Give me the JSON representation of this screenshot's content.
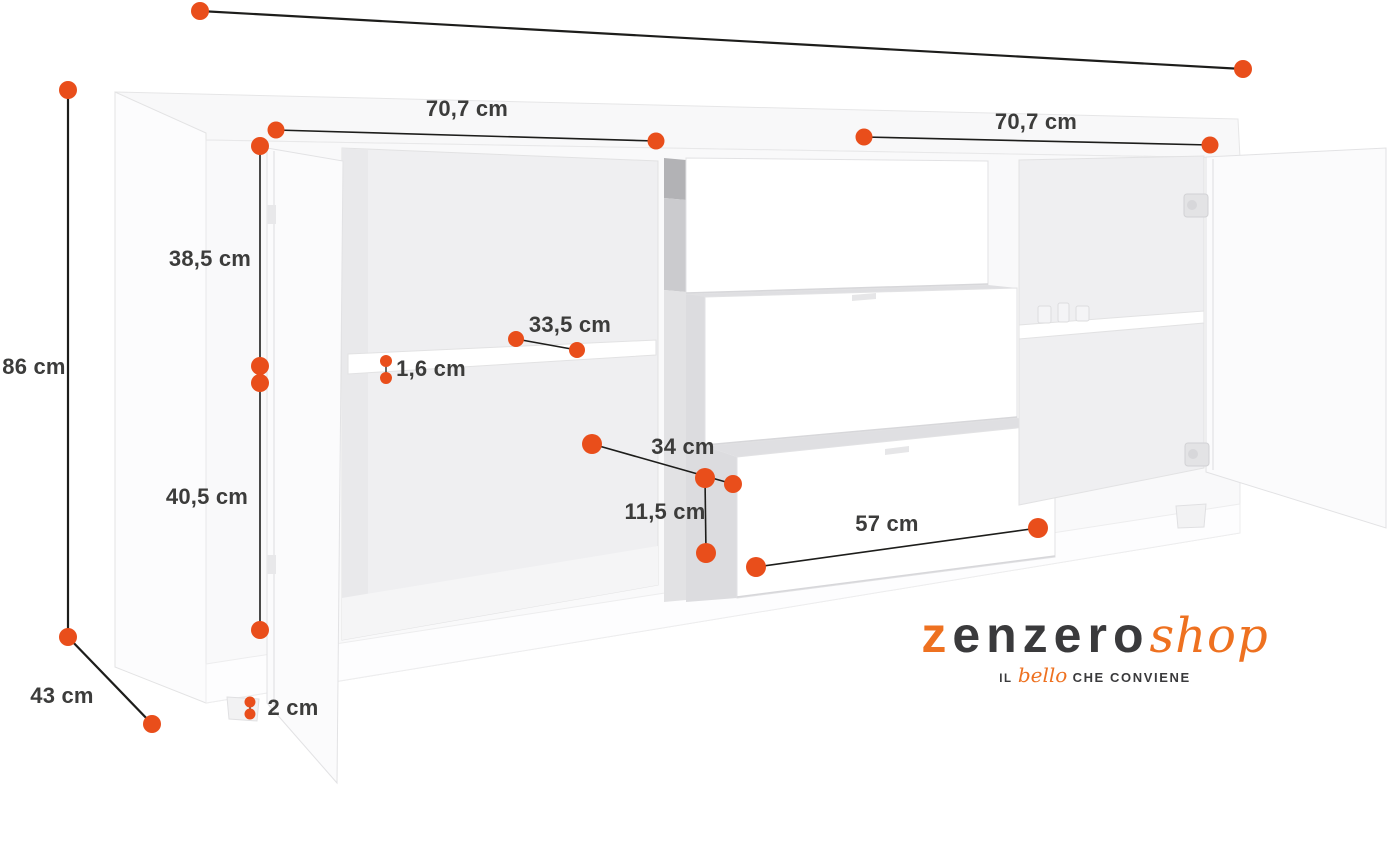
{
  "colors": {
    "accent": "#E94E1B",
    "logo_orange": "#EE7120",
    "ink": "#3C3C3B",
    "logo_gray": "#3A3A3C",
    "line": "#1D1D1B"
  },
  "measurements": [
    {
      "id": "width-left-section",
      "label": "70,7 cm"
    },
    {
      "id": "width-right-section",
      "label": "70,7 cm"
    },
    {
      "id": "total-height",
      "label": "86 cm"
    },
    {
      "id": "depth",
      "label": "43 cm"
    },
    {
      "id": "upper-compartment-height",
      "label": "38,5 cm"
    },
    {
      "id": "lower-compartment-height",
      "label": "40,5 cm"
    },
    {
      "id": "foot-height",
      "label": "2 cm"
    },
    {
      "id": "shelf-thickness",
      "label": "1,6 cm"
    },
    {
      "id": "shelf-depth",
      "label": "33,5 cm"
    },
    {
      "id": "drawer-inner-width",
      "label": "34 cm"
    },
    {
      "id": "drawer-inner-height",
      "label": "11,5 cm"
    },
    {
      "id": "drawer-front-width",
      "label": "57 cm"
    }
  ],
  "logo": {
    "brand_first_letter": "z",
    "brand_rest": "enzero",
    "brand_suffix": "shop",
    "tagline_prefix": "IL",
    "tagline_accent": "bello",
    "tagline_suffix": "CHE CONVIENE"
  }
}
